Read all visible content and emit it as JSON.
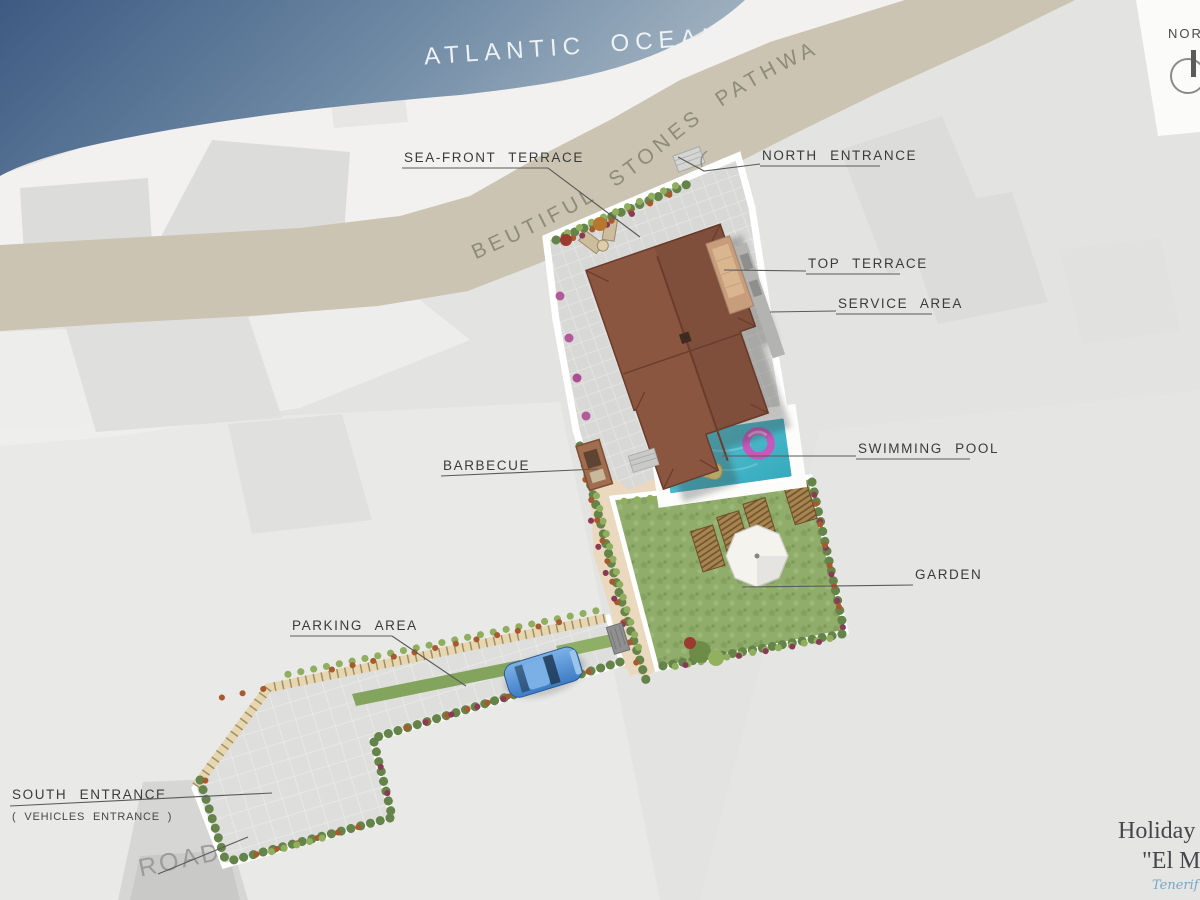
{
  "plan": {
    "ocean_label": "ATLANTIC OCEAN",
    "pathway_label": "BEUTIFUL STONES PATHWAY",
    "road_label": "ROAD",
    "compass_label": "NORTH",
    "annotations": {
      "sea_front_terrace": "SEA-FRONT TERRACE",
      "north_entrance": "NORTH ENTRANCE",
      "top_terrace": "TOP TERRACE",
      "service_area": "SERVICE AREA",
      "swimming_pool": "SWIMMING POOL",
      "barbecue": "BARBECUE",
      "garden": "GARDEN",
      "parking_area": "PARKING AREA",
      "south_entrance": "SOUTH ENTRANCE",
      "south_entrance_note": "( VEHICLES ENTRANCE )"
    },
    "title_block": {
      "line1": "Holiday H",
      "line2": "\"El Ma",
      "line3": "Tenerif"
    },
    "colors": {
      "ocean_deep": "#42608a",
      "ocean_light": "#9db1c1",
      "sand": "#f2f1ef",
      "pathway": "#cbc4b2",
      "background": "#e3e3e1",
      "roof_brown": "#8a5640",
      "pool_water": "#43b8c9",
      "garden_green": "#8fac6a",
      "patio_tan": "#ead9bf",
      "car_blue": "#5b9bd5",
      "label_ink": "#3b3b3b"
    }
  }
}
